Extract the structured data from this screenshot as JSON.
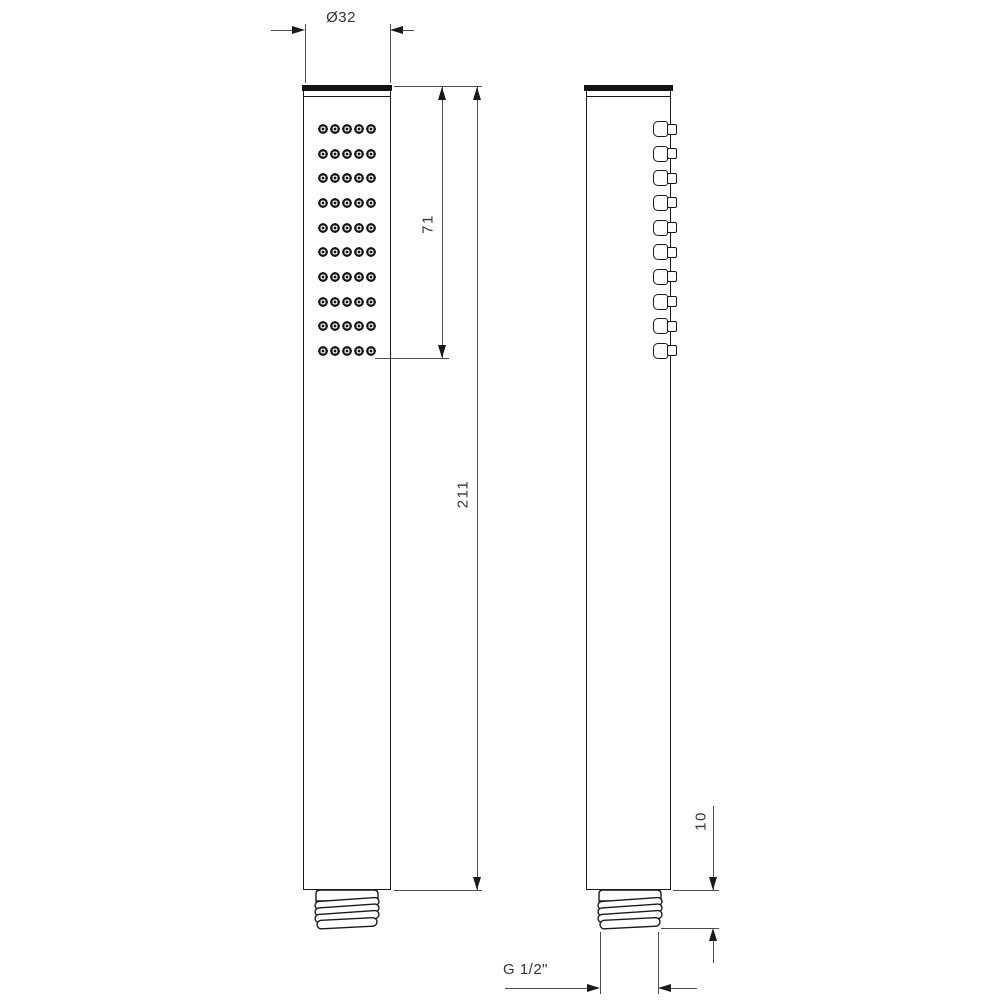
{
  "drawing": {
    "type": "technical-dimension-drawing",
    "subject": "handheld shower head, front and side orthographic views",
    "line_color": "#1a1a1a",
    "dimension_color": "#4d4d4d",
    "background": "#ffffff"
  },
  "front_view": {
    "name": "front view with spray face",
    "nozzle_rows": 10,
    "nozzle_cols": 5
  },
  "side_view": {
    "name": "side profile with nozzle bumps",
    "nozzle_rows": 10
  },
  "dimensions": {
    "diameter": "Ø32",
    "nozzle_area_height": "71",
    "total_height": "211",
    "thread_length": "10",
    "thread_spec": "G 1/2\""
  }
}
